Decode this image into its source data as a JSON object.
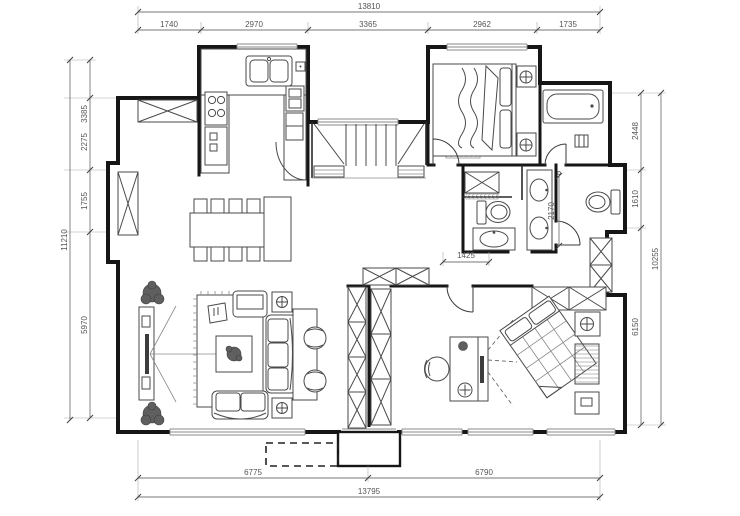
{
  "dims": {
    "top": {
      "total": "13810",
      "segments": [
        "1740",
        "2970",
        "3365",
        "2962",
        "1735"
      ]
    },
    "left": {
      "total": "11210",
      "segments": [
        "3385",
        "2275",
        "1755",
        "5970"
      ]
    },
    "right": {
      "total": "10255",
      "segments": [
        "2448",
        "1610",
        "6150"
      ]
    },
    "bottom": {
      "total": "13795",
      "segments": [
        "6775",
        "6790"
      ]
    },
    "interior": {
      "bath_depth": "2170",
      "hall_width": "1425"
    }
  }
}
